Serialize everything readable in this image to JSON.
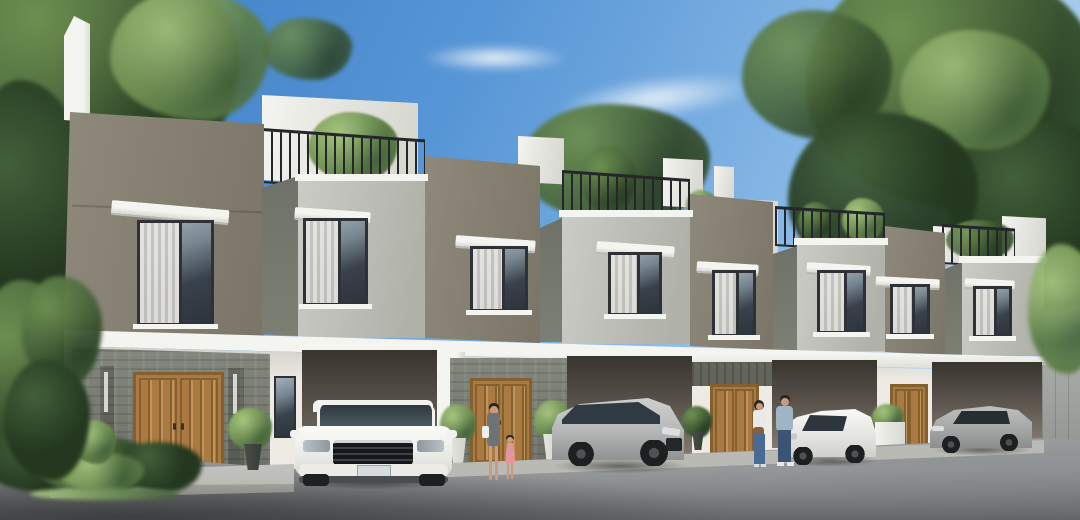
{
  "scene": {
    "type": "architectural-exterior-render",
    "title": "Row of modern two-storey townhouses, daytime 3D visualization",
    "setting": "clear blue sky with thin clouds, large leafy trees framing the left and right edges, grey asphalt driveway in the foreground",
    "building": {
      "storeys": 2,
      "visible_units": 4,
      "features": [
        "rooftop terraces with black metal railings and green plants",
        "white stair bulkheads and parapets above the roofline",
        "alternating taupe recessed walls and light-grey projecting volumes",
        "dark-framed windows with white curtains and white canopy awnings",
        "continuous white floor slab band between storeys",
        "stone-clad entrance walls with wooden double doors",
        "open carports with deep shadow",
        "potted plants flanking the entrances",
        "grey precast boundary wall at the far right"
      ]
    },
    "vehicles": [
      {
        "name": "white-suv-front",
        "color_key": "car_white",
        "description": "white compact SUV parked facing the viewer in the first carport"
      },
      {
        "name": "silver-suv",
        "color_key": "car_silver",
        "description": "silver SUV parked at an angle in front of the second unit"
      },
      {
        "name": "white-hatchback",
        "color_key": "car_white",
        "description": "white hatchback facing left near the third entrance"
      },
      {
        "name": "grey-crossover",
        "color_key": "car_grey",
        "description": "grey crossover parked in the far-right carport beside the boundary wall"
      }
    ],
    "people": [
      {
        "name": "woman-with-child",
        "description": "woman in a grey dress with a white shoulder bag walking with a small girl in a pink dress in front of the second entrance"
      },
      {
        "name": "couple",
        "description": "woman in a white top with a brown bag and a man in a light-blue t-shirt and jeans walking past the third entrance"
      }
    ]
  },
  "palette": {
    "sky_top": "#3a7ac2",
    "sky_mid": "#5796d6",
    "sky_low": "#8fbde8",
    "sky_horizon": "#cfe3f4",
    "cloud": "#ffffff",
    "foliage_dark": "#24381f",
    "foliage_mid": "#42603a",
    "foliage_light": "#6d8f50",
    "foliage_pale": "#a5c47e",
    "trunk": "#5a4836",
    "taupe": "#8e897b",
    "taupe_dark": "#7b7567",
    "tower_light": "#cbccc6",
    "tower_mid": "#b0b1a9",
    "tower_side": "#6f7268",
    "white_trim": "#f4f4f0",
    "trim_shadow": "#d8d8d1",
    "railing": "#24262a",
    "frame": "#2e3236",
    "glass_hi": "#a3b1ba",
    "glass_lo": "#39424c",
    "curtain": "#e6e5e1",
    "curtain_shade": "#c6c5c0",
    "stone": "#83877c",
    "stone_dark": "#6c7065",
    "accent_stone": "#63655c",
    "wood": "#aa7a42",
    "wood_dark": "#85602f",
    "wood_light": "#c2945c",
    "carport_top": "#38342e",
    "carport_low": "#827a6e",
    "gwall": "#edebe4",
    "gwall_shadow": "#cfccc4",
    "fence": "#909290",
    "walk": "#b9bab4",
    "walk_edge": "#9e9f99",
    "asphalt": "#8b8e90",
    "asphalt_light": "#9da0a1",
    "asphalt_dark": "#5f6264",
    "car_white": "#f2f2f0",
    "car_silver": "#b9bbbb",
    "car_grey": "#a7a9a9",
    "car_glass": "#2f3a42",
    "wheel": "#1d1f21",
    "skin": "#c89c80",
    "hair": "#2c2620",
    "dress_grey": "#6e7376",
    "dress_pink": "#e2979f",
    "top_white": "#e9e9e7",
    "jeans": "#4a6a92",
    "jeans_dark": "#3c5474",
    "tee_blue": "#9fb4c4",
    "bag_white": "#efefec",
    "bag_brown": "#8a5e3a",
    "pot_white": "#e8e7e1",
    "pot_dark": "#353a36"
  }
}
